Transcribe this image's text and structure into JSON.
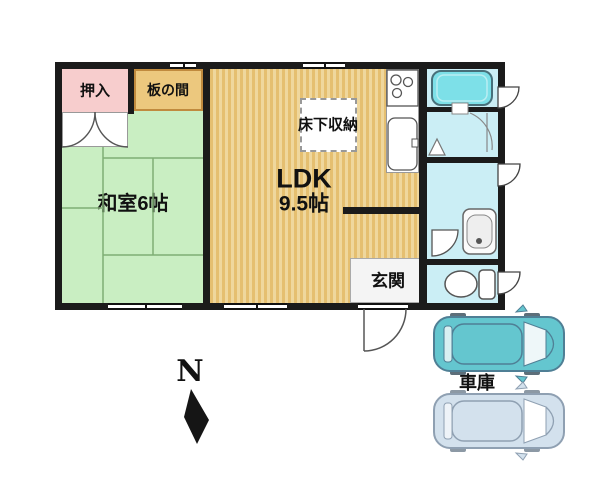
{
  "title": "apartment-floor-plan",
  "labels": {
    "oshiire": "押入",
    "itanoma": "板の間",
    "washitsu": "和室6帖",
    "ldk_line1": "LDK",
    "ldk_line2": "9.5帖",
    "yukashita": "床下収納",
    "genkan": "玄関",
    "garage": "車庫",
    "compass_north": "N"
  },
  "colors": {
    "wall": "#1b1b1b",
    "closet_pink": "#f7cdcd",
    "itanoma_tan": "#ecc87e",
    "itanoma_border": "#c08a3e",
    "washitsu_green": "#c9eec2",
    "tatami_line": "#7fae74",
    "ldk_wood_dark": "#e5bf70",
    "ldk_wood_light": "#efd79d",
    "wet_room_blue": "#cbeef5",
    "bathtub_teal": "#7de0e8",
    "genkan_gray": "#f4f4f4",
    "car_top_teal": "#64c6cf",
    "car_bottom_blue": "#d3e1ed"
  }
}
